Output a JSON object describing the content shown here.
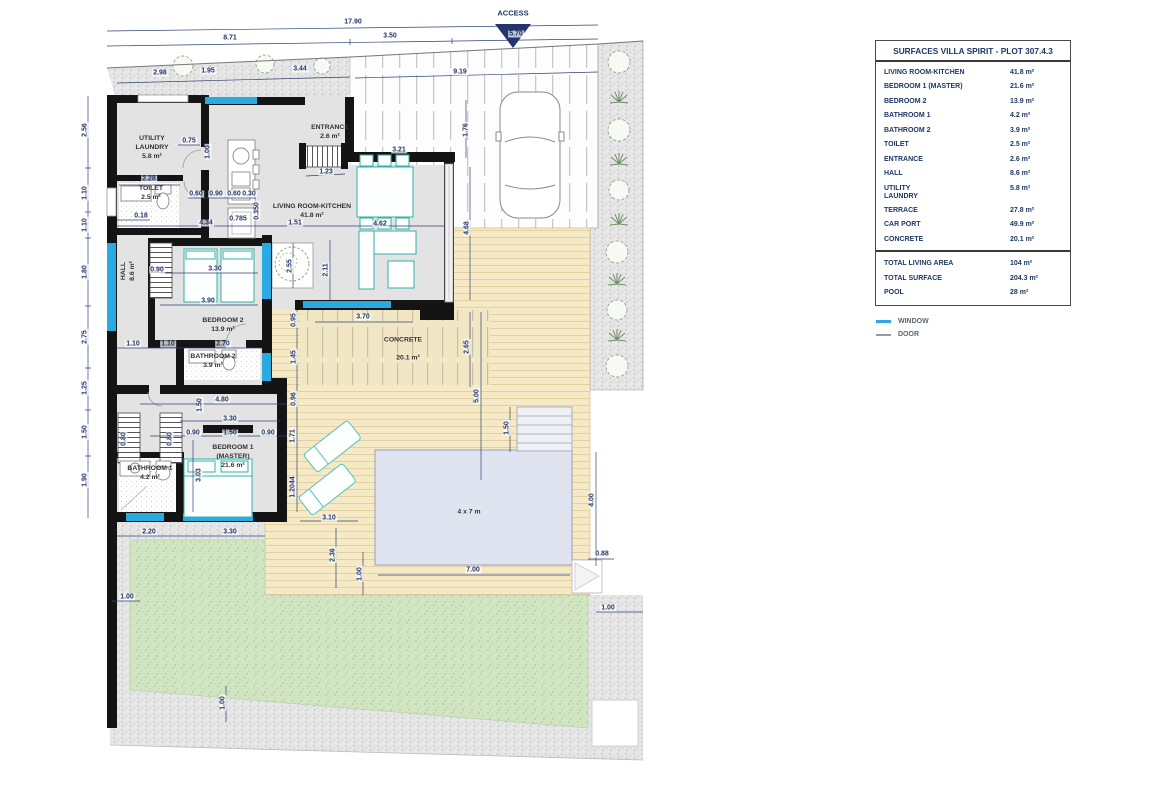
{
  "plan": {
    "access_label": "ACCESS",
    "pool_size_label": "4 x 7 m",
    "rooms": [
      {
        "label": "UTILITY\nLAUNDRY\n5.8 m²",
        "x": 152,
        "y": 148
      },
      {
        "label": "TOILET\n2.5 m²",
        "x": 151,
        "y": 194
      },
      {
        "label": "ENTRANCE\n2.6 m²",
        "x": 330,
        "y": 133
      },
      {
        "label": "LIVING ROOM-KITCHEN\n41.8 m²",
        "x": 312,
        "y": 212
      },
      {
        "label": "HALL\n8.6 m²",
        "x": 129,
        "y": 271,
        "v": true
      },
      {
        "label": "BEDROOM 2\n13.9 m²",
        "x": 223,
        "y": 326
      },
      {
        "label": "BATHROOM 2\n3.9 m²",
        "x": 213,
        "y": 362
      },
      {
        "label": "BEDROOM 1\n(MASTER)\n21.6 m²",
        "x": 233,
        "y": 457
      },
      {
        "label": "BATHROOM 1\n4.2 m²",
        "x": 150,
        "y": 474
      },
      {
        "label": "CONCRETE",
        "x": 403,
        "y": 341
      },
      {
        "label": "20.1 m²",
        "x": 408,
        "y": 359
      },
      {
        "label": "4 x 7 m",
        "x": 469,
        "y": 513
      }
    ],
    "dimensions": [
      {
        "t": "17.90",
        "x": 353,
        "y": 22
      },
      {
        "t": "8.71",
        "x": 230,
        "y": 38
      },
      {
        "t": "3.50",
        "x": 390,
        "y": 36
      },
      {
        "t": "5.70",
        "x": 516,
        "y": 34
      },
      {
        "t": "2.98",
        "x": 160,
        "y": 73
      },
      {
        "t": "1.95",
        "x": 208,
        "y": 71
      },
      {
        "t": "3.44",
        "x": 300,
        "y": 69
      },
      {
        "t": "9.19",
        "x": 460,
        "y": 72
      },
      {
        "t": "2.56",
        "x": 85,
        "y": 130,
        "v": true
      },
      {
        "t": "1.10",
        "x": 85,
        "y": 193,
        "v": true
      },
      {
        "t": "1.10",
        "x": 85,
        "y": 225,
        "v": true
      },
      {
        "t": "1.80",
        "x": 85,
        "y": 272,
        "v": true
      },
      {
        "t": "2.75",
        "x": 85,
        "y": 337,
        "v": true
      },
      {
        "t": "1.25",
        "x": 85,
        "y": 388,
        "v": true
      },
      {
        "t": "1.50",
        "x": 85,
        "y": 432,
        "v": true
      },
      {
        "t": "1.90",
        "x": 85,
        "y": 480,
        "v": true
      },
      {
        "t": "0.75",
        "x": 189,
        "y": 141
      },
      {
        "t": "1.00",
        "x": 208,
        "y": 152,
        "v": true
      },
      {
        "t": "2.28",
        "x": 149,
        "y": 179
      },
      {
        "t": "0.60",
        "x": 196,
        "y": 194
      },
      {
        "t": "0.90",
        "x": 216,
        "y": 194
      },
      {
        "t": "0.60",
        "x": 234,
        "y": 194
      },
      {
        "t": "0.30",
        "x": 249,
        "y": 194
      },
      {
        "t": "0.18",
        "x": 141,
        "y": 216
      },
      {
        "t": "4.34",
        "x": 206,
        "y": 223
      },
      {
        "t": "0.785",
        "x": 238,
        "y": 219
      },
      {
        "t": "0.350",
        "x": 257,
        "y": 211,
        "v": true
      },
      {
        "t": "1.51",
        "x": 295,
        "y": 223
      },
      {
        "t": "1.23",
        "x": 326,
        "y": 172
      },
      {
        "t": "3.21",
        "x": 399,
        "y": 150
      },
      {
        "t": "1.76",
        "x": 466,
        "y": 130,
        "v": true
      },
      {
        "t": "4.62",
        "x": 380,
        "y": 224
      },
      {
        "t": "2.11",
        "x": 326,
        "y": 270,
        "v": true
      },
      {
        "t": "4.68",
        "x": 467,
        "y": 228,
        "v": true
      },
      {
        "t": "2.55",
        "x": 290,
        "y": 266,
        "v": true
      },
      {
        "t": "0.95",
        "x": 294,
        "y": 320,
        "v": true
      },
      {
        "t": "1.45",
        "x": 294,
        "y": 357,
        "v": true
      },
      {
        "t": "0.96",
        "x": 294,
        "y": 399,
        "v": true
      },
      {
        "t": "1.71",
        "x": 293,
        "y": 436,
        "v": true
      },
      {
        "t": "1.2044",
        "x": 293,
        "y": 487,
        "v": true
      },
      {
        "t": "3.70",
        "x": 363,
        "y": 317
      },
      {
        "t": "2.65",
        "x": 467,
        "y": 347,
        "v": true
      },
      {
        "t": "5.00",
        "x": 477,
        "y": 396,
        "v": true
      },
      {
        "t": "0.90",
        "x": 157,
        "y": 270
      },
      {
        "t": "3.30",
        "x": 215,
        "y": 269
      },
      {
        "t": "3.90",
        "x": 208,
        "y": 301
      },
      {
        "t": "1.10",
        "x": 133,
        "y": 344
      },
      {
        "t": "1.10",
        "x": 168,
        "y": 344
      },
      {
        "t": "2.70",
        "x": 223,
        "y": 344
      },
      {
        "t": "1.50",
        "x": 200,
        "y": 405,
        "v": true
      },
      {
        "t": "4.80",
        "x": 222,
        "y": 400
      },
      {
        "t": "3.30",
        "x": 230,
        "y": 419
      },
      {
        "t": "0.90",
        "x": 193,
        "y": 433
      },
      {
        "t": "1.50",
        "x": 230,
        "y": 433
      },
      {
        "t": "0.90",
        "x": 268,
        "y": 433
      },
      {
        "t": "0.80",
        "x": 124,
        "y": 439,
        "v": true
      },
      {
        "t": "0.80",
        "x": 170,
        "y": 439,
        "v": true
      },
      {
        "t": "3.03",
        "x": 199,
        "y": 475,
        "v": true
      },
      {
        "t": "2.20",
        "x": 149,
        "y": 532
      },
      {
        "t": "3.30",
        "x": 230,
        "y": 532
      },
      {
        "t": "3.10",
        "x": 329,
        "y": 518
      },
      {
        "t": "2.36",
        "x": 333,
        "y": 555,
        "v": true
      },
      {
        "t": "1.00",
        "x": 360,
        "y": 574,
        "v": true
      },
      {
        "t": "7.00",
        "x": 473,
        "y": 570
      },
      {
        "t": "4.00",
        "x": 592,
        "y": 500,
        "v": true
      },
      {
        "t": "0.88",
        "x": 602,
        "y": 554
      },
      {
        "t": "1.50",
        "x": 507,
        "y": 428,
        "v": true
      },
      {
        "t": "1.00",
        "x": 127,
        "y": 597
      },
      {
        "t": "1.00",
        "x": 608,
        "y": 608
      },
      {
        "t": "1.00",
        "x": 223,
        "y": 703,
        "v": true
      }
    ]
  },
  "surfaces": {
    "title": "SURFACES VILLA SPIRIT - PLOT 307.4.3",
    "rows": [
      [
        "LIVING ROOM-KITCHEN",
        "41.8 m²"
      ],
      [
        "BEDROOM 1 (MASTER)",
        "21.6 m²"
      ],
      [
        "BEDROOM 2",
        "13.9 m²"
      ],
      [
        "BATHROOM 1",
        "4.2 m²"
      ],
      [
        "BATHROOM 2",
        "3.9 m²"
      ],
      [
        "TOILET",
        "2.5 m²"
      ],
      [
        "ENTRANCE",
        "2.6 m²"
      ],
      [
        "HALL",
        "8.6 m²"
      ],
      [
        "UTILITY\nLAUNDRY",
        "5.8 m²"
      ],
      [
        "TERRACE",
        "27.8 m²"
      ],
      [
        "CAR PORT",
        "49.9 m²"
      ],
      [
        "CONCRETE",
        "20.1 m²"
      ]
    ],
    "totals": [
      [
        "TOTAL LIVING AREA",
        "104 m²"
      ],
      [
        "TOTAL SURFACE",
        "204.3 m²"
      ],
      [
        "POOL",
        "28 m²"
      ]
    ]
  },
  "legend": {
    "window": "WINDOW",
    "door": "DOOR"
  },
  "colors": {
    "accent_navy": "#1f3864",
    "dimension_navy": "#24356b",
    "window_cyan": "#29abe2",
    "door_gray": "#9a9a9a",
    "furniture_teal": "#2fb3a6",
    "deck_tan": "#f5e9c6",
    "lawn_green": "#d2e5c2",
    "pool_blue": "#e0e4f0"
  }
}
